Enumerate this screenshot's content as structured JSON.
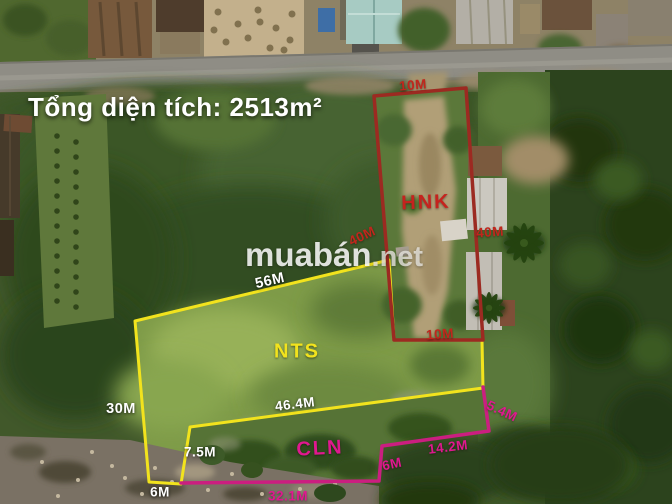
{
  "title": "Tổng diện tích: 2513m²",
  "watermark": {
    "brand": "muabán",
    "suffix": ".net"
  },
  "measurement_text_color": "#ffffff",
  "plots": {
    "hnk": {
      "name": "HNK",
      "line_color": "#9c2a21",
      "text_color": "#c1261c",
      "measurements": {
        "top": "10M",
        "left": "40M",
        "right": "40M",
        "bottom": "10M"
      }
    },
    "nts": {
      "name": "NTS",
      "line_color": "#f2e31d",
      "text_color": "#f2e31d",
      "measurements": {
        "top": "56M",
        "left": "30M",
        "bottom_left": "6M"
      }
    },
    "cln": {
      "name": "CLN",
      "line_color": "#cb1e80",
      "text_color": "#e0188f",
      "measurements": {
        "top": "46.4M",
        "left": "7.5M",
        "bottom": "32.1M",
        "right_lower": "6M",
        "right_diagonal": "14.2M",
        "right_upper": "5.4M"
      }
    }
  }
}
